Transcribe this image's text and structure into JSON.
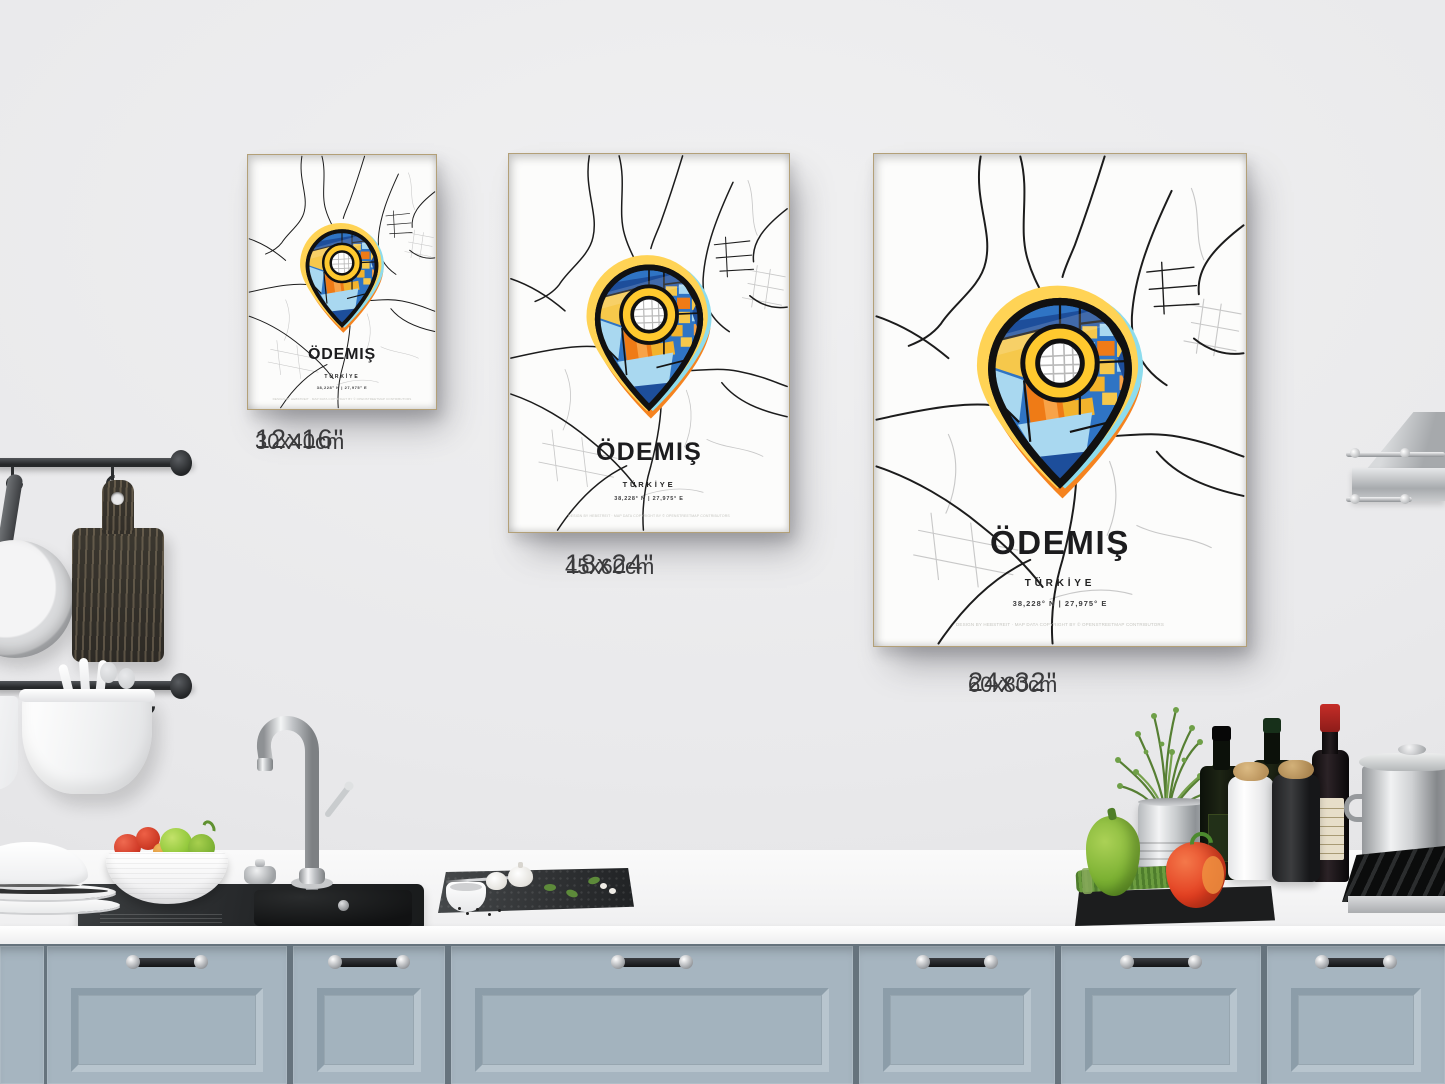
{
  "poster": {
    "title": "ÖDEMIŞ",
    "subtitle": "TÜRKİYE",
    "coordinates": "38,228° N | 27,975° E",
    "credit": "DESIGN BY HEBSTREIT · MAP DATA COPYRIGHT BY © OPENSTREETMAP CONTRIBUTORS"
  },
  "size_labels": [
    {
      "inches": "12x16\"",
      "cm": "30x40cm"
    },
    {
      "inches": "18x24\"",
      "cm": "45x60cm"
    },
    {
      "inches": "24x32\"",
      "cm": "60x80cm"
    }
  ],
  "pin_palette": {
    "halo_yellow": "#ffd355",
    "halo_cyan": "#8ddced",
    "halo_orange": "#f5831f",
    "blue": "#2f74c4",
    "navy": "#1d4e9b",
    "light_blue": "#a9d8f0",
    "yellow": "#f6c84b",
    "orange": "#ef7b16",
    "light_orange": "#f8a348",
    "gold": "#f3b32c",
    "ring_yellow": "#ffc92e"
  },
  "frame_color": "#dcc89f"
}
